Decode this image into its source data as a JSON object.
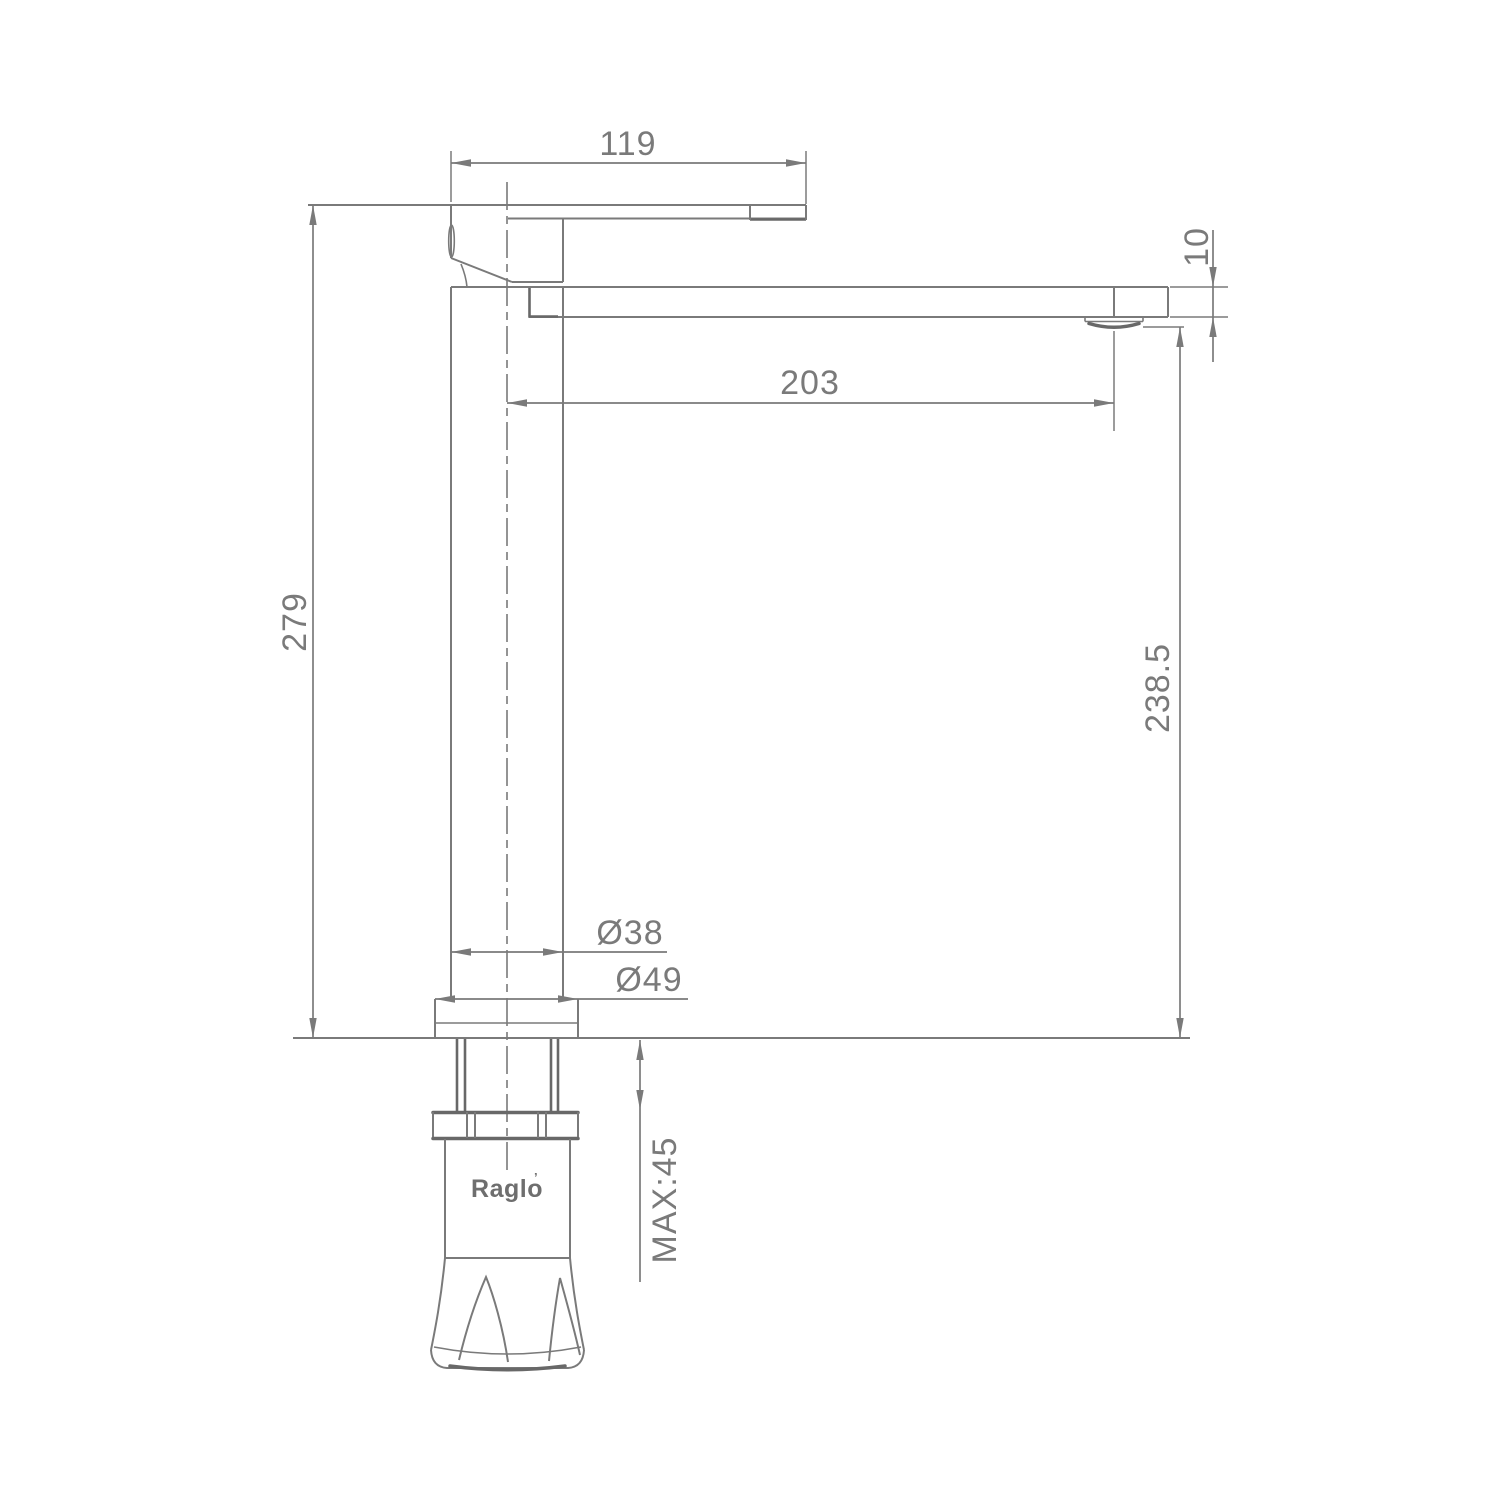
{
  "diagram": {
    "type": "faucet-technical-drawing",
    "brand": "Raglo",
    "brand_mark": "’",
    "dimensions": {
      "handle_length": "119",
      "spout_end_height": "10",
      "spout_reach": "203",
      "overall_height": "279",
      "deck_to_spout_height": "238.5",
      "body_diameter": "Ø38",
      "base_diameter": "Ø49",
      "max_deck_thickness": "MAX:45"
    },
    "colors": {
      "line": "#7a7a7a",
      "dark_line": "#686868",
      "text": "#7a7a7a",
      "background": "#ffffff"
    }
  }
}
